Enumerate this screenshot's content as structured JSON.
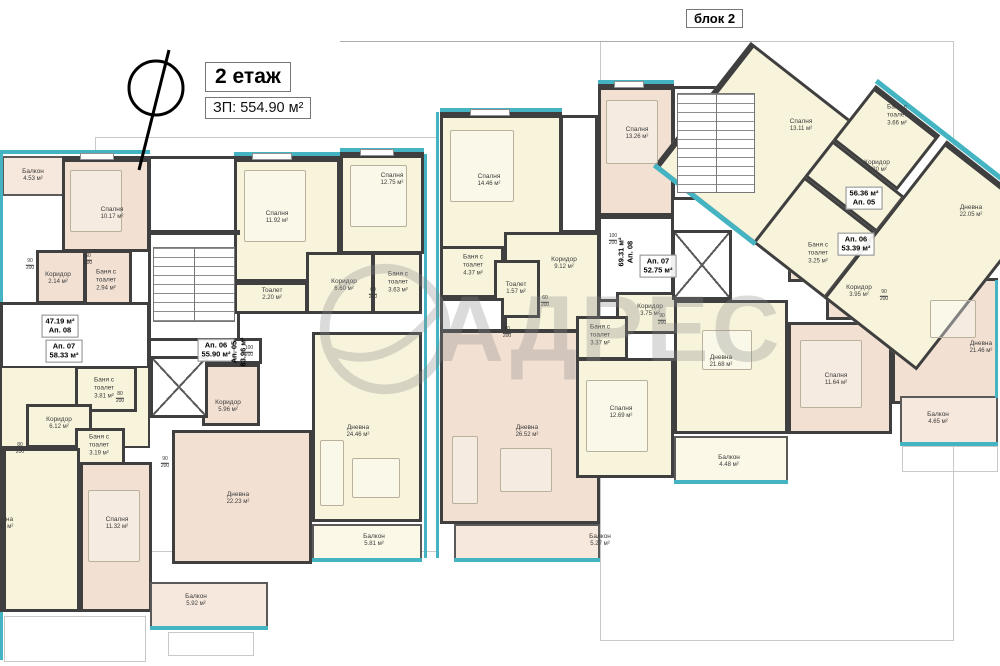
{
  "header": {
    "block_label": "блок 2",
    "floor_title": "2 етаж",
    "built_area": "ЗП: 554.90 м²"
  },
  "watermark": {
    "text": "АДРЕС"
  },
  "colors": {
    "wall": "#3f3f3f",
    "accent_teal": "#45b4c2",
    "room_yellow": "#f8f4dc",
    "room_pink": "#f2e0d2"
  },
  "apartments": [
    {
      "line1": "47.19 м²",
      "line2": "Ап. 08"
    },
    {
      "line1": "Ап. 07",
      "line2": "58.33 м²"
    },
    {
      "line1": "Ап. 06",
      "line2": "55.90 м²"
    },
    {
      "line1": "Ап. 05",
      "line2": "83.96 м²"
    },
    {
      "line1": "69.31 м²",
      "line2": "Ап. 08"
    },
    {
      "line1": "Ап. 07",
      "line2": "52.75 м²"
    },
    {
      "line1": "56.36 м²",
      "line2": "Ап. 05"
    },
    {
      "line1": "Ап. 06",
      "line2": "53.39 м²"
    }
  ],
  "rooms": [
    {
      "name": "Балкон",
      "area": "4.53 м²"
    },
    {
      "name": "Спалня",
      "area": "10.17 м²"
    },
    {
      "name": "Коридор",
      "area": "2.14 м²"
    },
    {
      "name": "Баня с тоалет",
      "area": "2.94 м²"
    },
    {
      "name": "Спалня",
      "area": "11.92 м²"
    },
    {
      "name": "Спалня",
      "area": "12.75 м²"
    },
    {
      "name": "Тоалет",
      "area": "2.20 м²"
    },
    {
      "name": "Коридор",
      "area": "6.60 м²"
    },
    {
      "name": "Баня с тоалет",
      "area": "3.63 м²"
    },
    {
      "name": "Баня с тоалет",
      "area": "3.81 м²"
    },
    {
      "name": "Коридор",
      "area": "6.12 м²"
    },
    {
      "name": "Баня с тоалет",
      "area": "3.19 м²"
    },
    {
      "name": "Коридор",
      "area": "5.96 м²"
    },
    {
      "name": "Дневна",
      "area": "22.23 м²"
    },
    {
      "name": "Спалня",
      "area": "11.32 м²"
    },
    {
      "name": "Дневна",
      "area": "20.51 м²"
    },
    {
      "name": "Балкон",
      "area": "5.92 м²"
    },
    {
      "name": "Дневна",
      "area": "24.46 м²"
    },
    {
      "name": "Балкон",
      "area": "5.81 м²"
    },
    {
      "name": "Спалня",
      "area": "14.46 м²"
    },
    {
      "name": "Баня с тоалет",
      "area": "4.37 м²"
    },
    {
      "name": "Тоалет",
      "area": "1.57 м²"
    },
    {
      "name": "Коридор",
      "area": "9.12 м²"
    },
    {
      "name": "Спалня",
      "area": "13.26 м²"
    },
    {
      "name": "Дневна",
      "area": "26.52 м²"
    },
    {
      "name": "Балкон",
      "area": "5.27 м²"
    },
    {
      "name": "Коридор",
      "area": "3.75 м²"
    },
    {
      "name": "Баня с тоалет",
      "area": "3.37 м²"
    },
    {
      "name": "Спалня",
      "area": "12.69 м²"
    },
    {
      "name": "Дневна",
      "area": "21.68 м²"
    },
    {
      "name": "Балкон",
      "area": "4.48 м²"
    },
    {
      "name": "Спалня",
      "area": "13.11 м²"
    },
    {
      "name": "Баня с тоалет",
      "area": "3.66 м²"
    },
    {
      "name": "Коридор",
      "area": "3.20 м²"
    },
    {
      "name": "Дневна",
      "area": "22.05 м²"
    },
    {
      "name": "Баня с тоалет",
      "area": "3.25 м²"
    },
    {
      "name": "Коридор",
      "area": "3.95 м²"
    },
    {
      "name": "Спалня",
      "area": "11.64 м²"
    },
    {
      "name": "Дневна",
      "area": "21.46 м²"
    },
    {
      "name": "Балкон",
      "area": "4.65 м²"
    }
  ],
  "dims": [
    {
      "top": "90",
      "bottom": "200"
    },
    {
      "top": "60",
      "bottom": "200"
    },
    {
      "top": "100",
      "bottom": "200"
    },
    {
      "top": "80",
      "bottom": "200"
    },
    {
      "top": "80",
      "bottom": "200"
    },
    {
      "top": "90",
      "bottom": "200"
    },
    {
      "top": "60",
      "bottom": "200"
    },
    {
      "top": "100",
      "bottom": "200"
    },
    {
      "top": "90",
      "bottom": "200"
    },
    {
      "top": "90",
      "bottom": "200"
    },
    {
      "top": "80",
      "bottom": "200"
    },
    {
      "top": "60",
      "bottom": "200"
    }
  ]
}
